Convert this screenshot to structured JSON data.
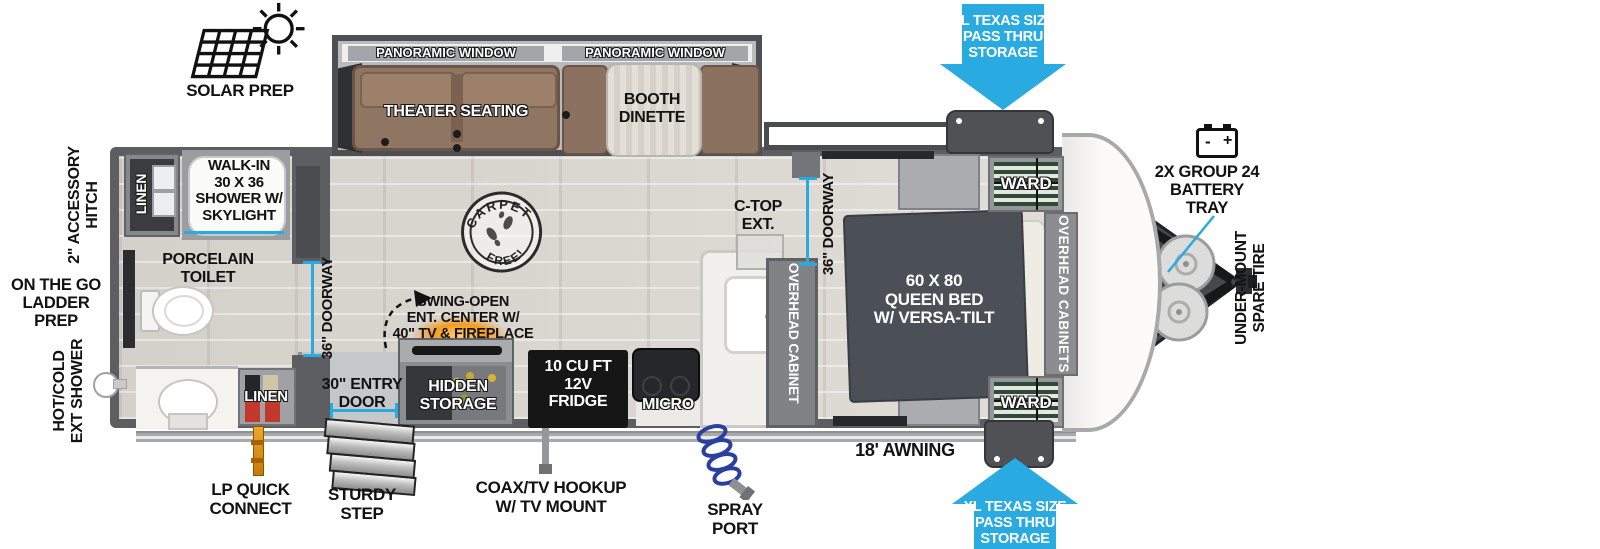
{
  "colors": {
    "arrow_blue": "#29ABE2",
    "measure_cyan": "#29ABE2",
    "wall_gray": "#5c5e62",
    "bed_gray": "#4b4f56",
    "sofa_brown": "#8f7662",
    "fireplace_orange": "#f59b1d",
    "lp_orange": "#e8920e"
  },
  "exterior_callouts": {
    "solar_prep": "SOLAR PREP",
    "accessory_hitch": "2\" ACCESSORY\nHITCH",
    "ladder_prep": "ON THE GO\nLADDER PREP",
    "ext_shower": "HOT/COLD\nEXT SHOWER",
    "lp_quick_connect": "LP QUICK\nCONNECT",
    "sturdy_step": "STURDY\nSTEP",
    "coax_tv_hookup": "COAX/TV HOOKUP\nW/ TV MOUNT",
    "spray_port": "SPRAY\nPORT",
    "awning": "18' AWNING",
    "pass_thru_storage_top": "XL TEXAS SIZE\nPASS THRU\nSTORAGE",
    "pass_thru_storage_bottom": "XL TEXAS SIZE\nPASS THRU\nSTORAGE",
    "battery_tray": "2X GROUP 24\nBATTERY\nTRAY",
    "spare_tire": "UNDER-MOUNT\nSPARE TIRE"
  },
  "battery_icon": {
    "minus": "-",
    "plus": "+"
  },
  "slide_out": {
    "panoramic_window_left": "PANORAMIC WINDOW",
    "panoramic_window_right": "PANORAMIC WINDOW",
    "theater_seating": "THEATER SEATING",
    "booth_dinette": "BOOTH\nDINETTE"
  },
  "bathroom": {
    "linen_top": "LINEN",
    "shower": "WALK-IN\n30 X 36\nSHOWER W/\nSKYLIGHT",
    "toilet": "PORCELAIN\nTOILET",
    "linen_bottom": "LINEN",
    "doorway": "36\" DOORWAY"
  },
  "kitchen": {
    "entry_door": "30\" ENTRY\nDOOR",
    "ent_center": "SWING-OPEN\nENT. CENTER W/\n40\" TV & FIREPLACE",
    "hidden_storage": "HIDDEN\nSTORAGE",
    "fridge": "10 CU FT\n12V\nFRIDGE",
    "micro": "MICRO",
    "ctop_ext": "C-TOP\nEXT.",
    "overhead_cabinet": "OVERHEAD CABINET"
  },
  "bedroom": {
    "doorway": "36\" DOORWAY",
    "bed": "60 X 80\nQUEEN BED\nW/ VERSA-TILT",
    "ward_top": "WARD",
    "ward_bottom": "WARD",
    "overhead_cabinets": "OVERHEAD CABINETS"
  },
  "stamp": {
    "arc_top": "CARPET",
    "arc_bottom": "FREE!"
  }
}
